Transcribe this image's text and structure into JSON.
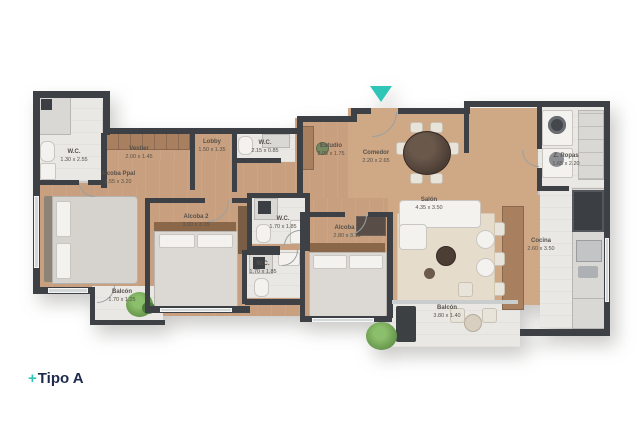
{
  "title": {
    "prefix": "+",
    "text": "Tipo A"
  },
  "entrance": {
    "marker": "entrance-arrow",
    "color": "#2fc6b7"
  },
  "colors": {
    "accent_teal": "#2fc6b7",
    "wall_dark": "#3d4146",
    "wood_floor": "#c9a07f",
    "tile_floor": "#e9e8e4",
    "title_navy": "#1d2a4c",
    "plant_green": "#6fa053"
  },
  "rooms": [
    {
      "name": "W.C.",
      "dims": "1.30 x 2.55"
    },
    {
      "name": "Vestier",
      "dims": "2.00 x 1.45"
    },
    {
      "name": "Alcoba Ppal",
      "dims": "3.55 x 3.20"
    },
    {
      "name": "Lobby",
      "dims": "1.50 x 1.35"
    },
    {
      "name": "W.C.",
      "dims": "2.15 x 0.85"
    },
    {
      "name": "Estudio",
      "dims": "2.05 x 1.75"
    },
    {
      "name": "Comedor",
      "dims": "2.20 x 2.65"
    },
    {
      "name": "Z. Ropas",
      "dims": "1.65 x 2.20"
    },
    {
      "name": "Salón",
      "dims": "4.35 x 3.50"
    },
    {
      "name": "Cocina",
      "dims": "2.60 x 3.50"
    },
    {
      "name": "Alcoba 2",
      "dims": "3.00 x 3.15"
    },
    {
      "name": "Alcoba 3",
      "dims": "2.80 x 3.15"
    },
    {
      "name": "W.C.",
      "dims": "1.70 x 1.85"
    },
    {
      "name": "W.C.",
      "dims": "1.70 x 1.85"
    },
    {
      "name": "Balcón",
      "dims": "1.70 x 1.25"
    },
    {
      "name": "Balcón",
      "dims": "3.80 x 1.40"
    }
  ]
}
